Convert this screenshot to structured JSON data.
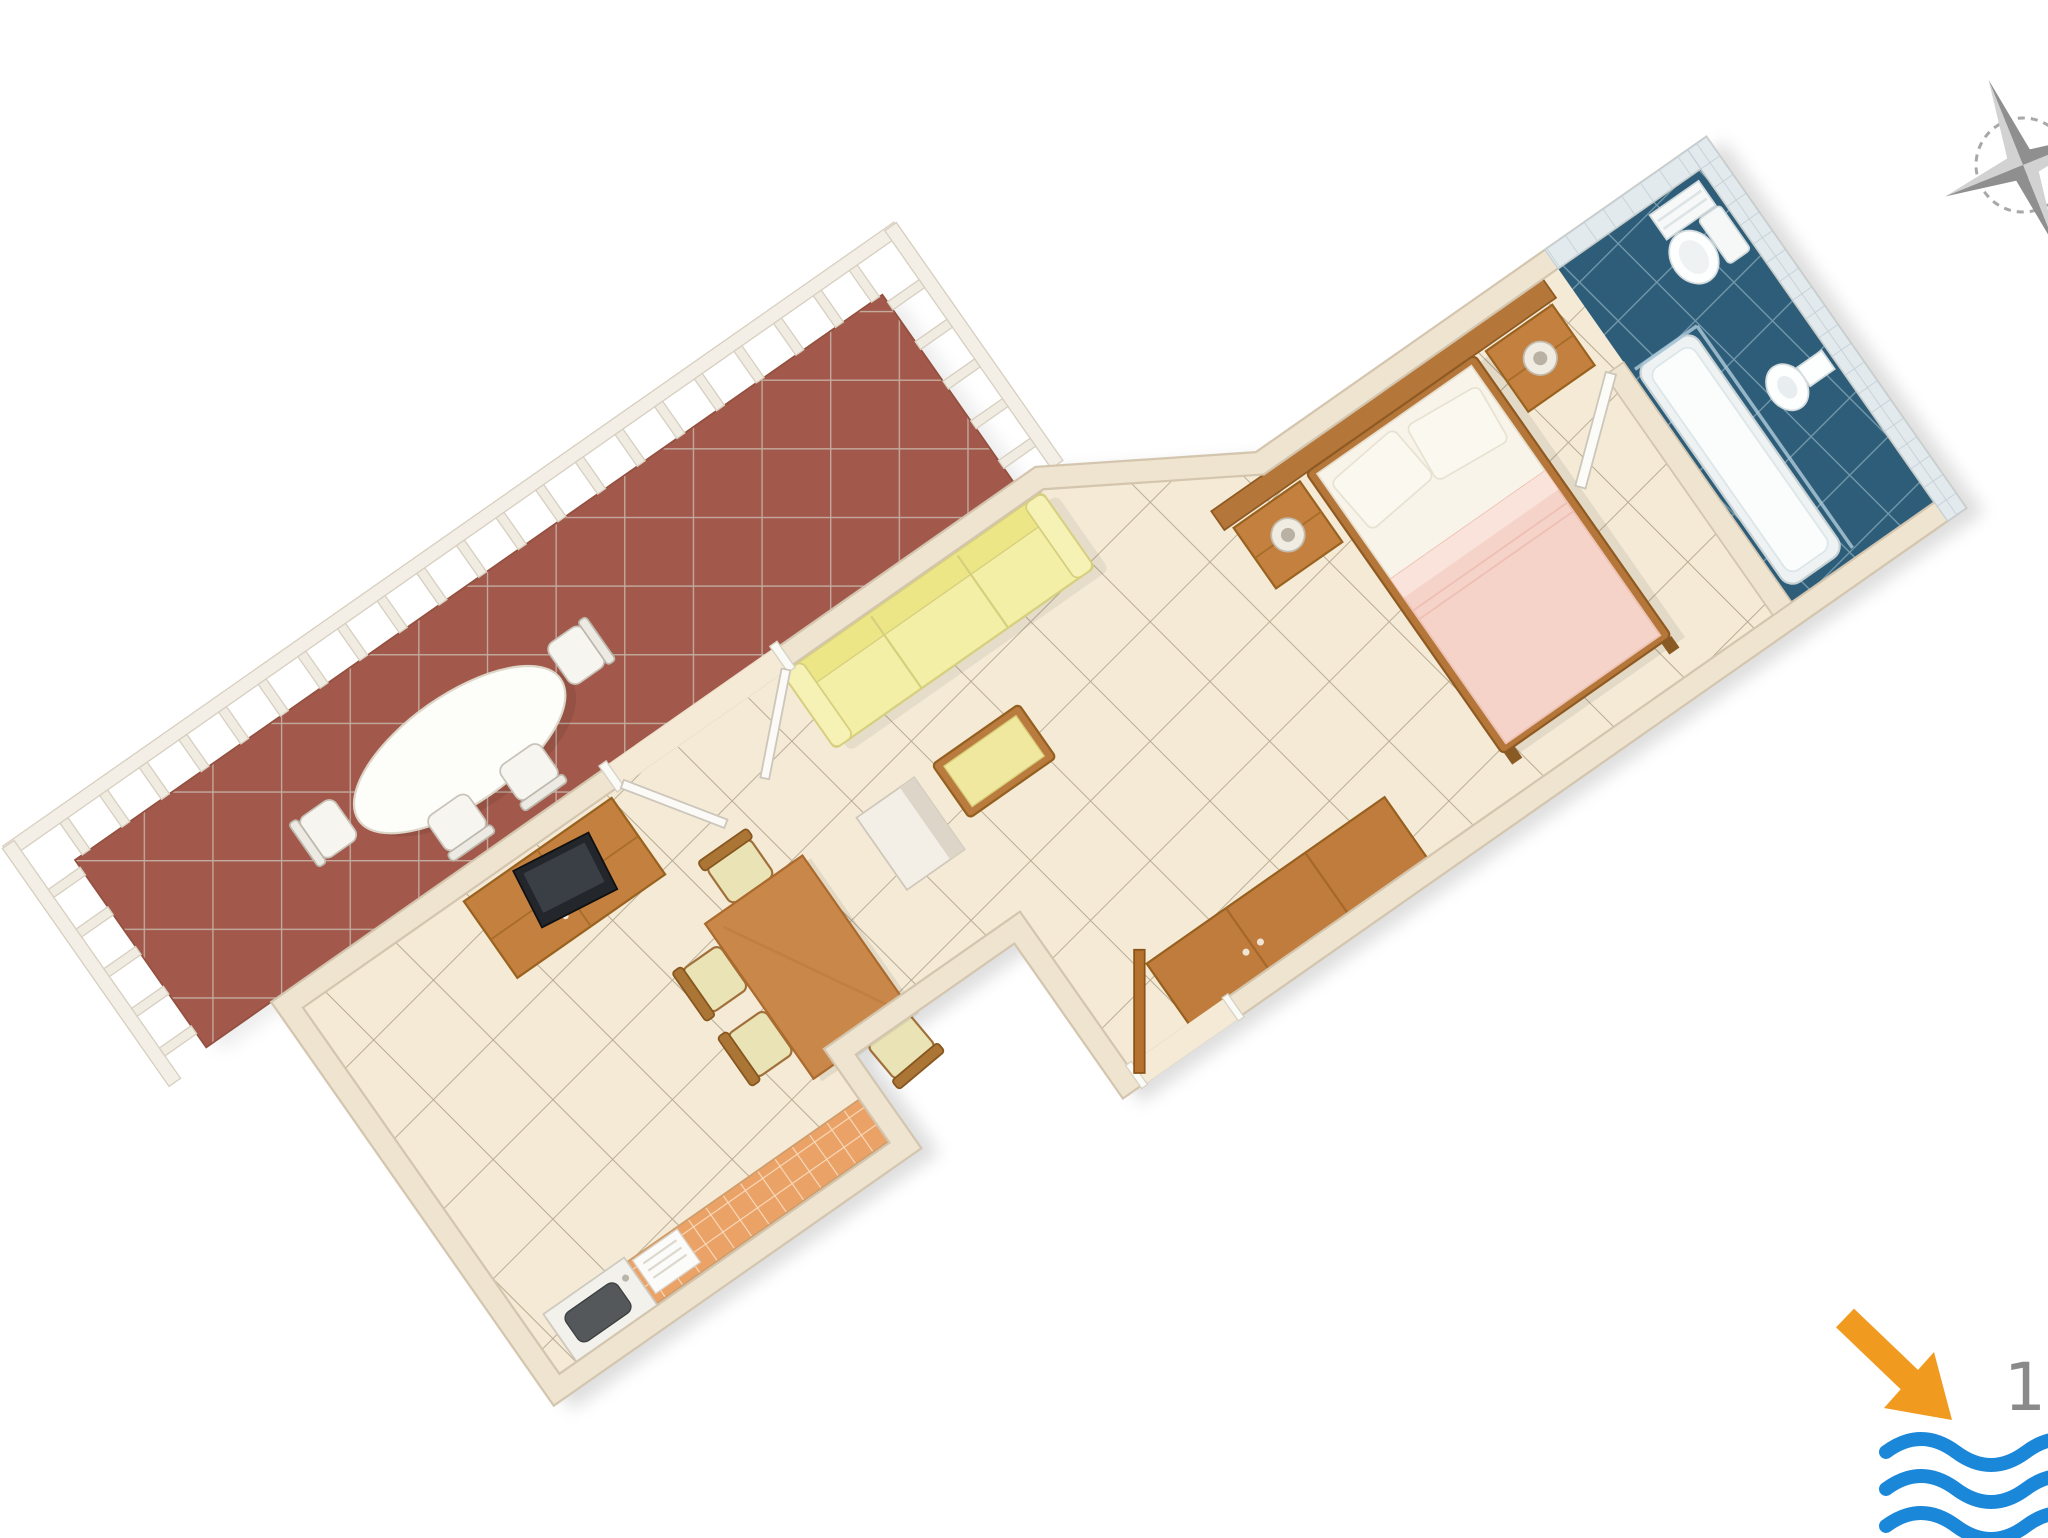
{
  "scene": {
    "title": "3D floor plan rendering of a studio apartment with terrace",
    "view": "top-down axonometric, plan rotated diagonally on white background"
  },
  "annotations": {
    "distance_label": "15",
    "distance_label_color": "#8a8a8a",
    "arrow_color": "#f09a20",
    "waves_color": "#1b87d9",
    "compass_color": "#9b9b9b",
    "compass_light_color": "#d2d2d2"
  },
  "rooms": {
    "terrace": {
      "name": "terrace",
      "floor_color": "#a2584a",
      "furniture": [
        "oval-dining-table",
        "terrace-chair",
        "terrace-chair",
        "terrace-chair",
        "terrace-chair"
      ],
      "features": [
        "white-railing-with-balusters"
      ]
    },
    "main_room": {
      "name": "combined living / bedroom",
      "floor_color": "#f4ead6",
      "furniture": [
        "yellow-sofa",
        "tv-cabinet-with-tv",
        "dining-table",
        "dining-chair",
        "dining-chair",
        "dining-chair",
        "dining-chair",
        "column",
        "bench",
        "double-bed",
        "nightstand-with-lamp",
        "nightstand-with-lamp",
        "wardrobe"
      ],
      "features": [
        "french-doors-to-terrace",
        "entrance-door"
      ]
    },
    "kitchenette": {
      "name": "kitchenette corner",
      "counter_color": "#eba266",
      "furniture": [
        "tiled-counter",
        "sink",
        "drainer"
      ]
    },
    "bathroom": {
      "name": "bathroom",
      "floor_color": "#2e5d79",
      "wall_tile_color": "#e3eaee",
      "furniture": [
        "bathtub",
        "shower-screen",
        "toilet",
        "bidet",
        "wall-shelf"
      ],
      "features": [
        "bathroom-door"
      ]
    }
  },
  "palette": {
    "wall": "#efe4d0",
    "wall_edge": "#d3c5ae",
    "wood": "#c4803f",
    "wood_dark": "#9a621f",
    "sofa": "#f3efa6",
    "blanket_pink": "#f5d3c8",
    "mattress": "#f8f4ea"
  }
}
